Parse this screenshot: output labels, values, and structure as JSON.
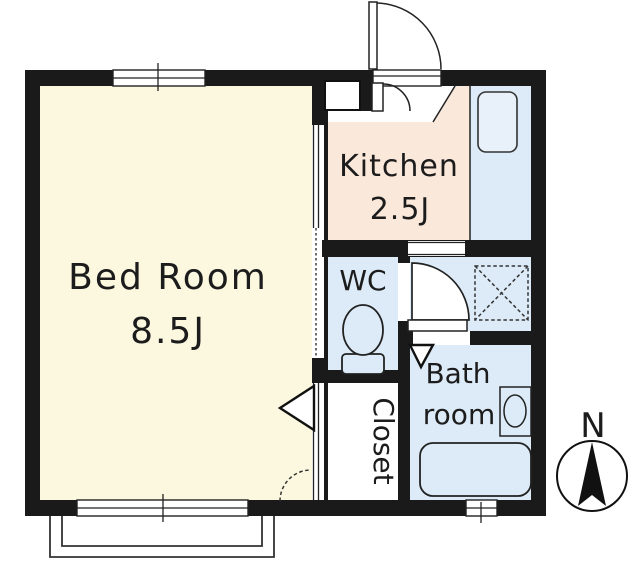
{
  "floorplan": {
    "bedroom": {
      "label": "Bed Room",
      "area": "8.5J"
    },
    "kitchen": {
      "label": "Kitchen",
      "area": "2.5J"
    },
    "wc": {
      "label": "WC"
    },
    "bathroom": {
      "label_line1": "Bath",
      "label_line2": "room"
    },
    "closet": {
      "label": "Closet"
    },
    "compass": {
      "label": "N"
    },
    "colors": {
      "bedroom": "#fbf8df",
      "kitchen": "#fae8db",
      "wet": "#dcebf7",
      "wall": "#1a1a1a",
      "line": "#222222",
      "outline": "#333333"
    }
  }
}
